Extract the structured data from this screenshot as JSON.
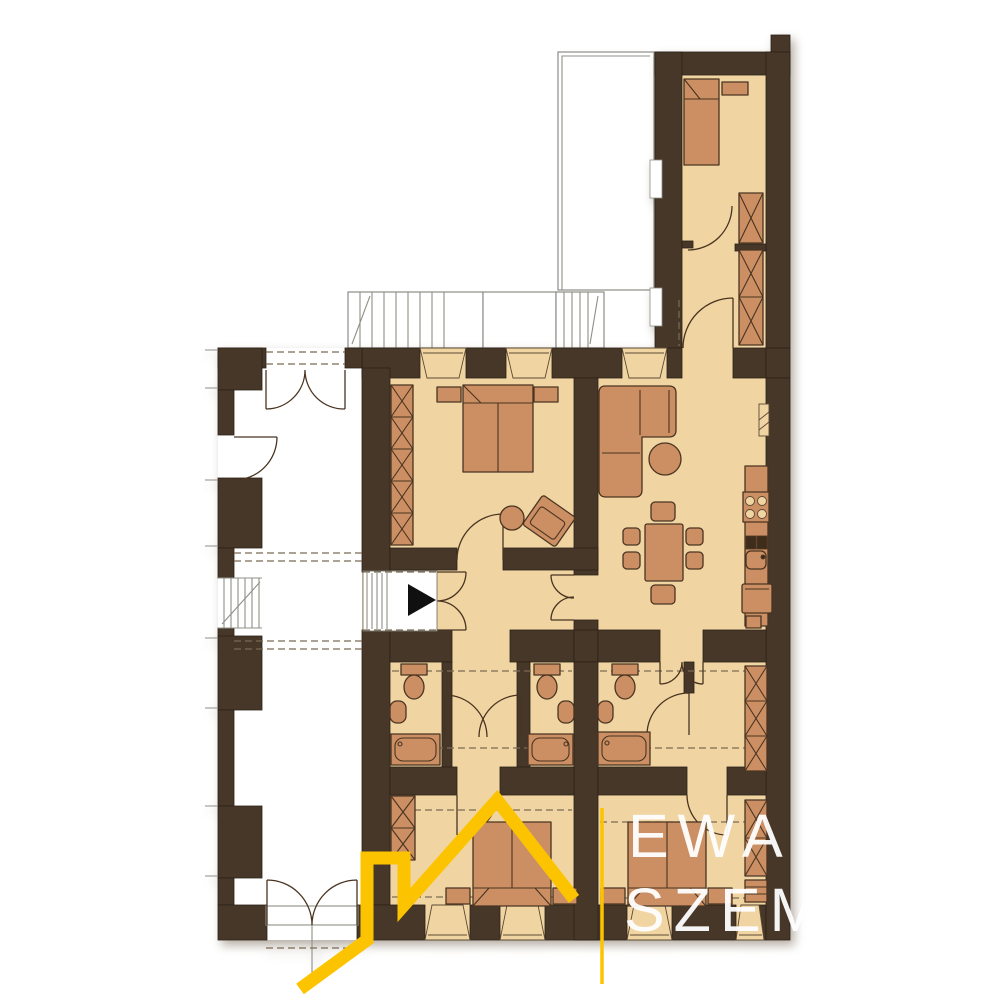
{
  "watermark": {
    "line1": "EWA",
    "line2": "SZEM",
    "logo_shape": "house-roofline-logo"
  },
  "palette": {
    "wall": "#473729",
    "floor": "#f0d5a3",
    "furn": "#cb8f63",
    "outline": "#4a3421",
    "dark_fix": "#3f2d1c",
    "thin": "#8f8f87",
    "dash": "#7b6a55",
    "logo_yellow": "#fcc400",
    "wm_text": "#ffffff",
    "arrow": "#101010",
    "background": "#ffffff"
  },
  "plan": {
    "type": "apartment-floor-plan",
    "symbols": {
      "entrance_arrow_icon": "black-triangle-right",
      "door_icon": "quarter-arc-swing",
      "double_door_icon": "butterfly-arcs",
      "window_icon": "splayed-trapezoid-opening",
      "wardrobe_icon": "crossed-box",
      "stairs_icon": "hatched-treads",
      "bed_icon": "rect-with-pillow-line",
      "sofa_icon": "l-shaped-corner-sofa",
      "dining_icon": "table-with-six-chairs",
      "kitchen_icons": [
        "counter",
        "stove-4-burners",
        "double-sink",
        "fridge"
      ],
      "bath_icons": [
        "toilet",
        "washbasin",
        "bathtub"
      ]
    },
    "rooms": [
      {
        "name": "north-wing-bedroom",
        "furniture": [
          "single-bed",
          "desk",
          "wardrobes"
        ]
      },
      {
        "name": "north-wing-corridor",
        "furniture": [
          "wardrobes"
        ]
      },
      {
        "name": "bedroom-west",
        "furniture": [
          "double-bed",
          "nightstands",
          "wardrobe",
          "armchair",
          "side-table"
        ]
      },
      {
        "name": "living-room-kitchen",
        "furniture": [
          "corner-sofa",
          "coffee-table",
          "dining-table",
          "chairs",
          "stove",
          "sink",
          "fridge"
        ]
      },
      {
        "name": "entrance-hall",
        "furniture": [
          "entrance-arrow"
        ]
      },
      {
        "name": "bathroom-1",
        "furniture": [
          "toilet",
          "washbasin",
          "bathtub"
        ]
      },
      {
        "name": "bathroom-2",
        "furniture": [
          "toilet",
          "washbasin",
          "bathtub"
        ]
      },
      {
        "name": "bathroom-3",
        "furniture": [
          "toilet",
          "washbasin",
          "bathtub",
          "wardrobe"
        ]
      },
      {
        "name": "bedroom-south-left",
        "furniture": [
          "double-bed",
          "nightstands",
          "wardrobe"
        ]
      },
      {
        "name": "bedroom-south-right",
        "furniture": [
          "double-bed",
          "nightstands",
          "wardrobe",
          "dresser"
        ]
      },
      {
        "name": "common-staircase",
        "furniture": [
          "stairs",
          "doors"
        ]
      },
      {
        "name": "terrace-exterior-stairs",
        "furniture": [
          "stairs"
        ]
      }
    ]
  }
}
